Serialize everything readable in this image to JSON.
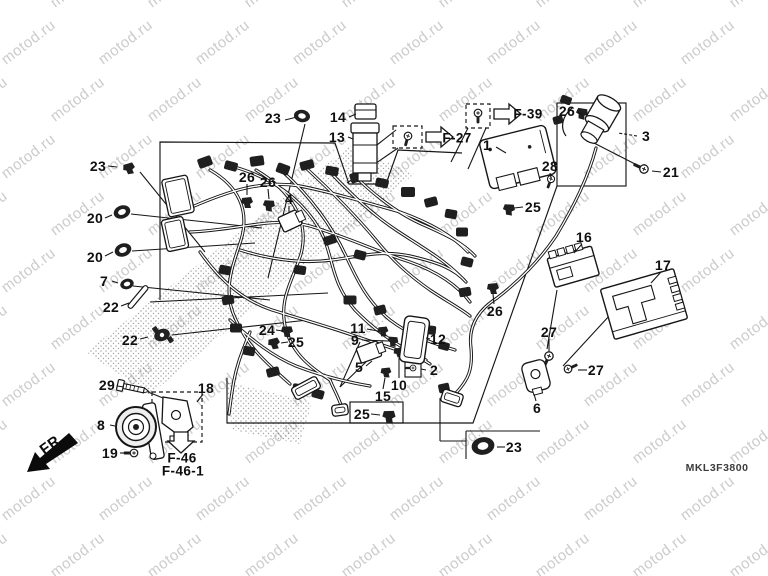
{
  "watermark": {
    "text": "motod.ru",
    "color": "#a0a0a0"
  },
  "diagram": {
    "code": "MKL3F3800",
    "fr": {
      "label": "FR."
    },
    "refs": {
      "f27": {
        "label": "F-27"
      },
      "f39": {
        "label": "F-39"
      },
      "f46": {
        "label": "F-46"
      },
      "f461": {
        "label": "F-46-1"
      }
    },
    "callouts": [
      {
        "label": "23",
        "x": 273,
        "y": 118,
        "leader": [
          285,
          120,
          297,
          117
        ]
      },
      {
        "label": "14",
        "x": 338,
        "y": 117,
        "leader": [
          349,
          117,
          356,
          114
        ]
      },
      {
        "label": "13",
        "x": 337,
        "y": 137,
        "leader": [
          348,
          137,
          353,
          139
        ]
      },
      {
        "label": "1",
        "x": 487,
        "y": 145,
        "leader": [
          496,
          147,
          506,
          153
        ]
      },
      {
        "label": "26",
        "x": 567,
        "y": 111,
        "leader": [
          577,
          112,
          582,
          114
        ]
      },
      {
        "label": "3",
        "x": 646,
        "y": 136,
        "leader": null
      },
      {
        "label": "21",
        "x": 671,
        "y": 172,
        "leader": [
          661,
          172,
          652,
          171
        ]
      },
      {
        "label": "28",
        "x": 550,
        "y": 166,
        "leader": [
          550,
          173,
          551,
          178
        ]
      },
      {
        "label": "25",
        "x": 533,
        "y": 207,
        "leader": [
          523,
          207,
          514,
          208
        ]
      },
      {
        "label": "16",
        "x": 584,
        "y": 237,
        "leader": [
          582,
          244,
          574,
          253
        ]
      },
      {
        "label": "17",
        "x": 663,
        "y": 265,
        "leader": [
          661,
          272,
          651,
          283
        ]
      },
      {
        "label": "26",
        "x": 495,
        "y": 311,
        "leader": [
          494,
          304,
          493,
          294
        ]
      },
      {
        "label": "27",
        "x": 549,
        "y": 332,
        "leader": [
          549,
          339,
          549,
          351
        ]
      },
      {
        "label": "27",
        "x": 596,
        "y": 370,
        "leader": [
          587,
          370,
          578,
          370
        ]
      },
      {
        "label": "6",
        "x": 537,
        "y": 408,
        "leader": [
          536,
          401,
          534,
          394
        ]
      },
      {
        "label": "23",
        "x": 514,
        "y": 447,
        "leader": [
          505,
          447,
          497,
          447
        ]
      },
      {
        "label": "24",
        "x": 267,
        "y": 330,
        "leader": [
          276,
          330,
          283,
          331
        ]
      },
      {
        "label": "25",
        "x": 296,
        "y": 342,
        "leader": [
          288,
          342,
          281,
          343
        ]
      },
      {
        "label": "11",
        "x": 358,
        "y": 328,
        "leader": [
          367,
          329,
          378,
          331
        ]
      },
      {
        "label": "9",
        "x": 355,
        "y": 340,
        "leader": [
          362,
          340,
          388,
          341
        ]
      },
      {
        "label": "5",
        "x": 359,
        "y": 367,
        "leader": [
          366,
          366,
          372,
          361
        ]
      },
      {
        "label": "15",
        "x": 383,
        "y": 396,
        "leader": [
          383,
          389,
          385,
          378
        ]
      },
      {
        "label": "10",
        "x": 399,
        "y": 385,
        "leader": [
          399,
          378,
          399,
          358
        ]
      },
      {
        "label": "2",
        "x": 434,
        "y": 370,
        "leader": [
          426,
          370,
          421,
          369
        ]
      },
      {
        "label": "12",
        "x": 438,
        "y": 339,
        "leader": [
          430,
          339,
          426,
          338
        ]
      },
      {
        "label": "25",
        "x": 362,
        "y": 414,
        "leader": [
          371,
          414,
          380,
          415
        ]
      },
      {
        "label": "22",
        "x": 111,
        "y": 307,
        "leader": [
          121,
          306,
          129,
          303
        ]
      },
      {
        "label": "22",
        "x": 130,
        "y": 340,
        "leader": [
          140,
          339,
          148,
          337
        ]
      },
      {
        "label": "29",
        "x": 107,
        "y": 385,
        "leader": [
          117,
          386,
          124,
          387
        ]
      },
      {
        "label": "8",
        "x": 101,
        "y": 425,
        "leader": [
          110,
          425,
          115,
          426
        ]
      },
      {
        "label": "19",
        "x": 110,
        "y": 453,
        "leader": [
          120,
          453,
          128,
          453
        ]
      },
      {
        "label": "18",
        "x": 206,
        "y": 388,
        "leader": [
          203,
          394,
          197,
          402
        ]
      },
      {
        "label": "23",
        "x": 98,
        "y": 166,
        "leader": [
          108,
          166,
          117,
          167
        ]
      },
      {
        "label": "20",
        "x": 95,
        "y": 218,
        "leader": [
          105,
          218,
          112,
          215
        ]
      },
      {
        "label": "20",
        "x": 95,
        "y": 257,
        "leader": [
          105,
          256,
          113,
          252
        ]
      },
      {
        "label": "7",
        "x": 104,
        "y": 281,
        "leader": [
          112,
          281,
          118,
          283
        ]
      },
      {
        "label": "4",
        "x": 289,
        "y": 199,
        "leader": [
          289,
          206,
          289,
          213
        ]
      },
      {
        "label": "26",
        "x": 247,
        "y": 177,
        "leader": [
          247,
          184,
          247,
          195
        ]
      },
      {
        "label": "26",
        "x": 268,
        "y": 182,
        "leader": [
          268,
          189,
          269,
          199
        ]
      }
    ]
  }
}
